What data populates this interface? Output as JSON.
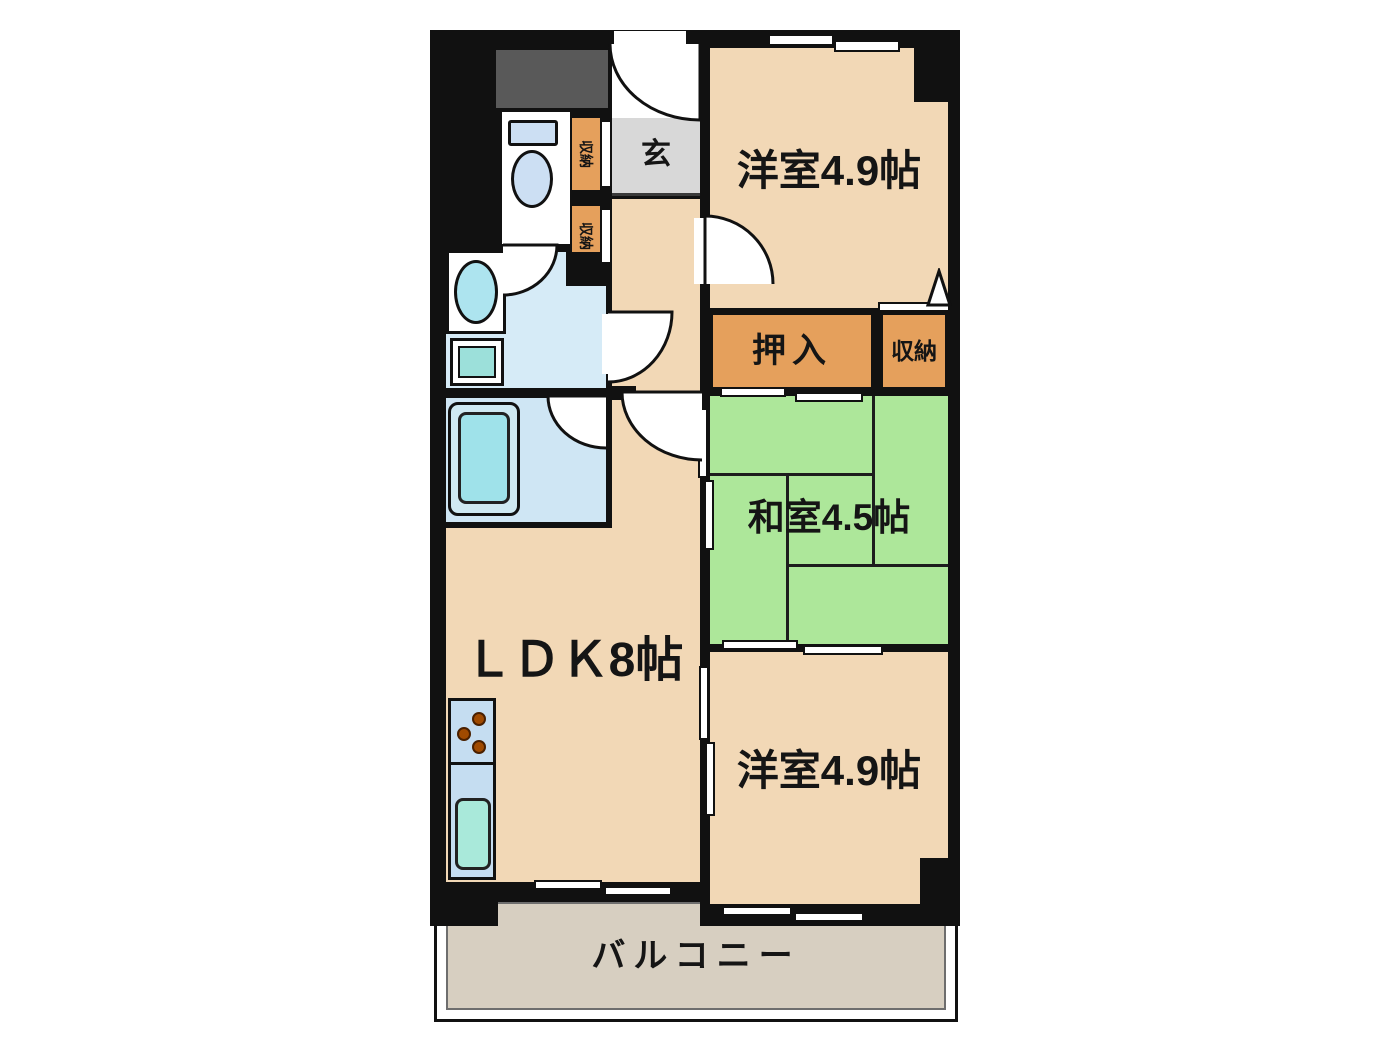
{
  "plan": {
    "rooms": {
      "genkan": {
        "label": "玄"
      },
      "western_room_top": {
        "label": "洋室4.9帖"
      },
      "oshiire": {
        "label": "押入"
      },
      "storage": {
        "label": "収納"
      },
      "japanese_room": {
        "label": "和室4.5帖"
      },
      "ldk": {
        "label": "ＬＤＫ8帖"
      },
      "western_room_bottom": {
        "label": "洋室4.9帖"
      },
      "balcony": {
        "label": "バルコニー"
      },
      "hall_closet_upper": {
        "label": "収納"
      },
      "hall_closet_lower": {
        "label": "収納"
      }
    },
    "colors": {
      "wall": "#111111",
      "wood_floor": "#f2d8b6",
      "tatami_green": "#ade79a",
      "closet_orange": "#e5a05c",
      "genkan_gray": "#d8d8d8",
      "wet_area_blue": "#d6ebf7",
      "bathroom_blue": "#cfe6f4",
      "fixture_cyan": "#9fe2ea",
      "balcony_floor": "#d7cfc1",
      "service_box_gray": "#595959"
    }
  }
}
